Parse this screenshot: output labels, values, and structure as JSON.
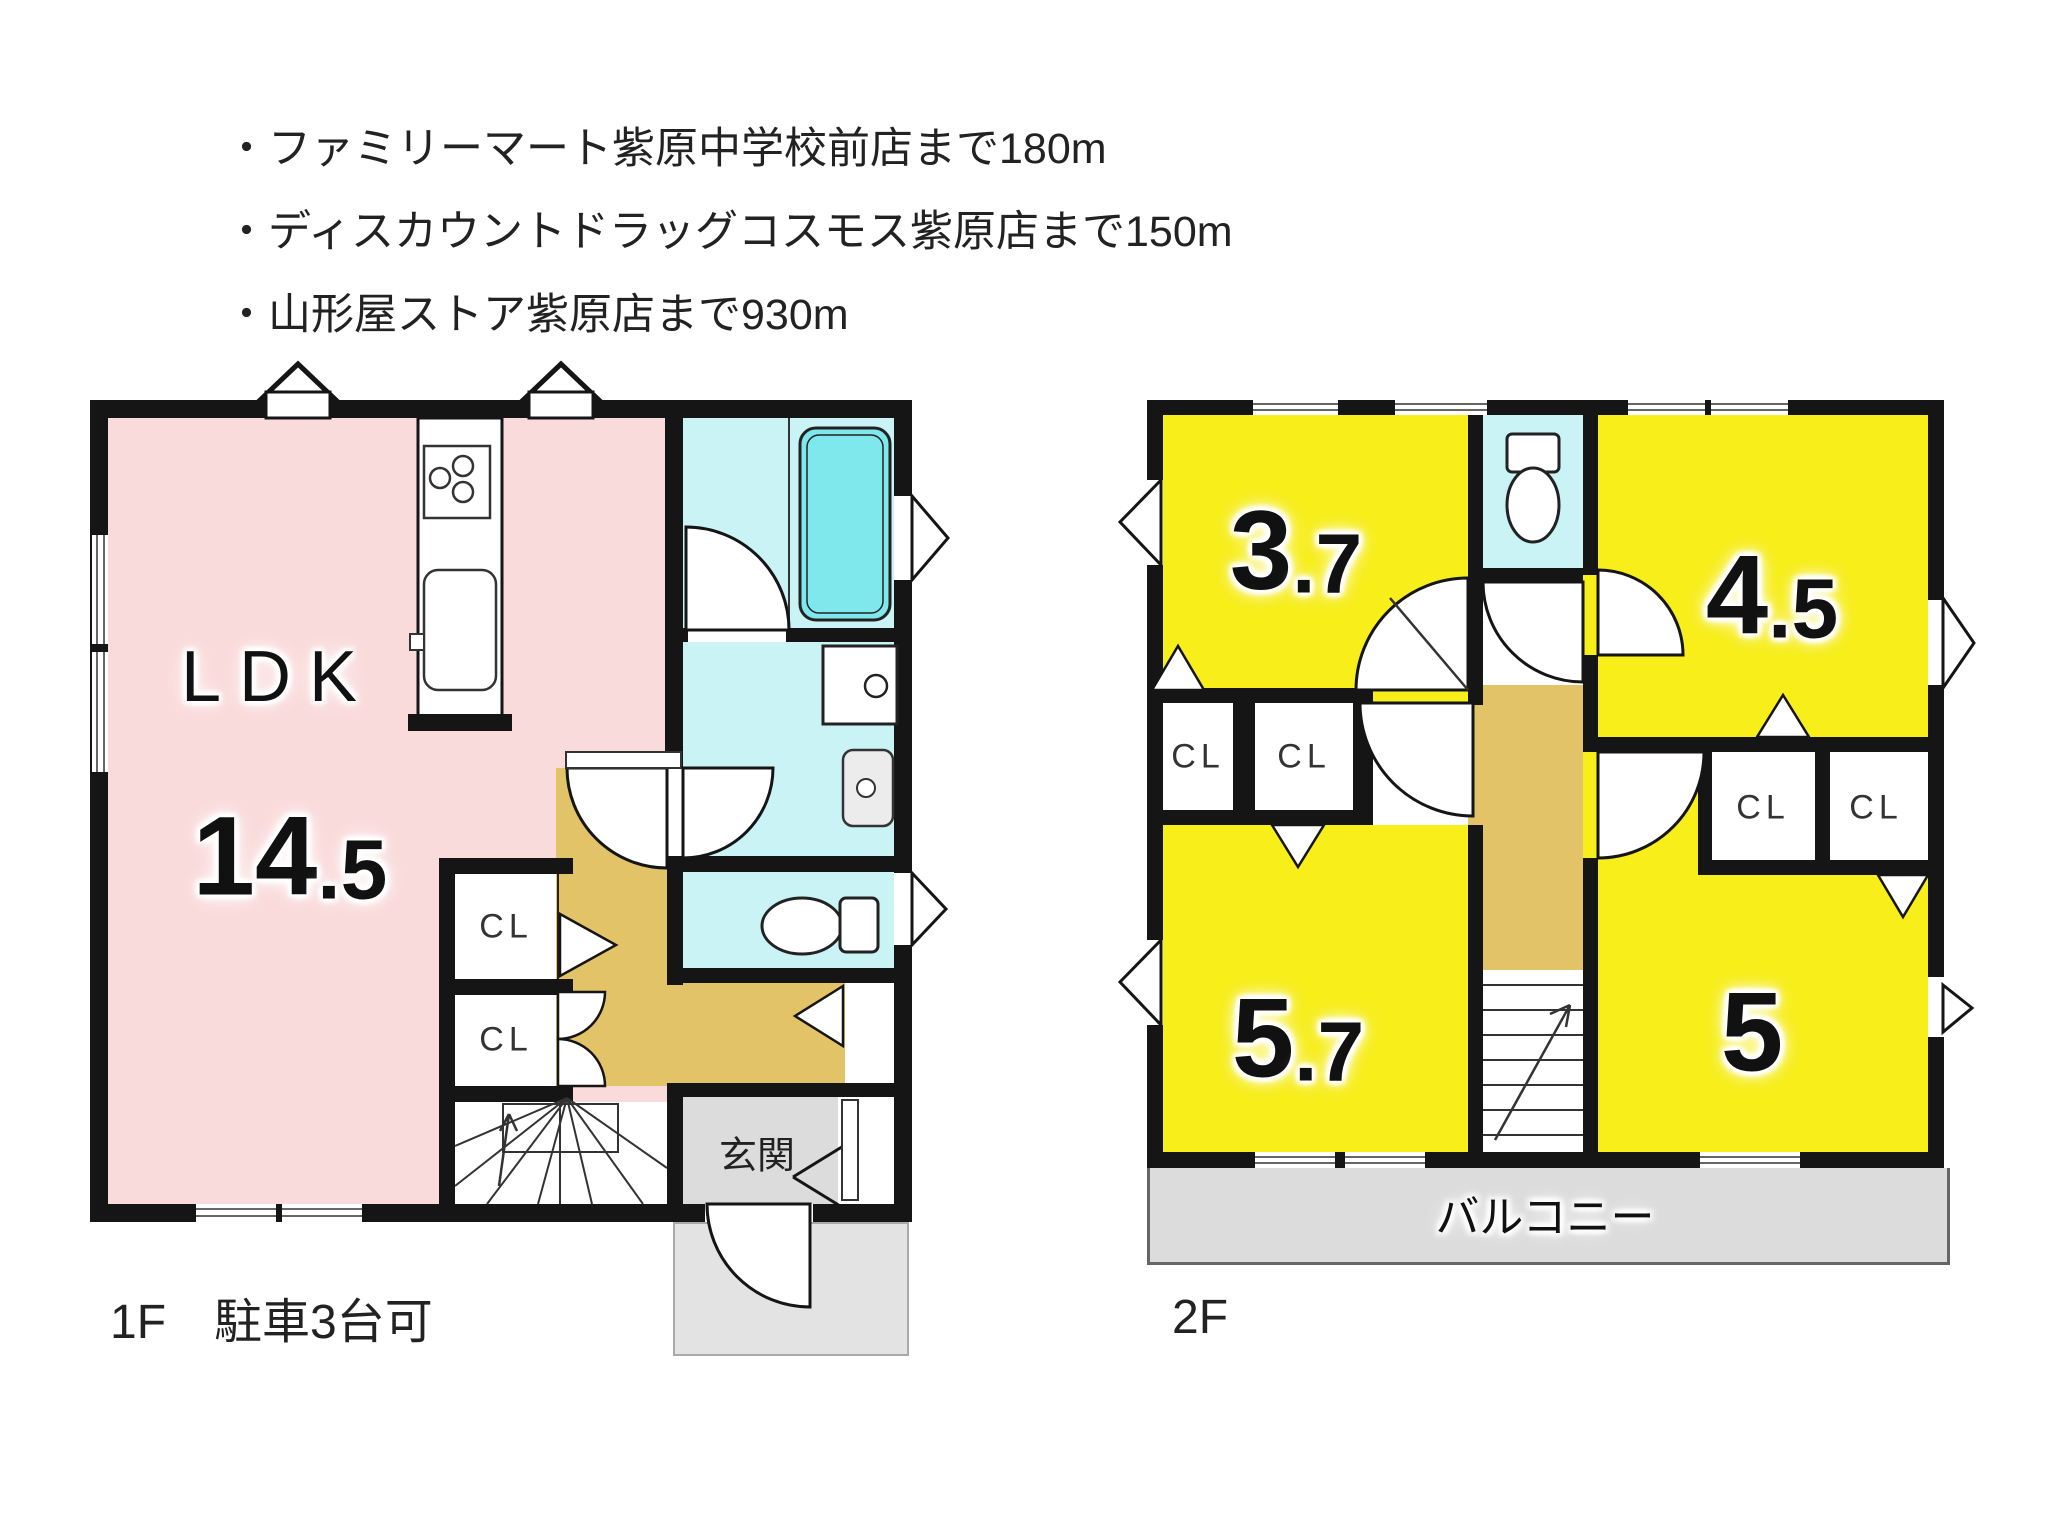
{
  "notes": {
    "items": [
      "・ファミリーマート紫原中学校前店まで180m",
      "・ディスカウントドラッグコスモス紫原店まで150m",
      "・山形屋ストア紫原店まで930m"
    ]
  },
  "floor1": {
    "caption": "1F　駐車3台可",
    "ldk_label": "LDK",
    "ldk_size_main": "14",
    "ldk_size_sub": ".5",
    "cl1": "CL",
    "cl2": "CL",
    "entrance": "玄関"
  },
  "floor2": {
    "caption": "2F",
    "balcony": "バルコニー",
    "rooms": {
      "r37_main": "3",
      "r37_sub": ".7",
      "r45_main": "4",
      "r45_sub": ".5",
      "r57_main": "5",
      "r57_sub": ".7",
      "r5_main": "5"
    },
    "closets": {
      "c1": "CL",
      "c2": "CL",
      "c3": "CL",
      "c4": "CL"
    }
  },
  "colors": {
    "ldk_pink": "#fadbdb",
    "room_yellow": "#f7ee1a",
    "wet_cyan": "#c9f3f4",
    "tub_cyan": "#7fe8ec",
    "hall_tan": "#e2c368",
    "entrance_gray": "#dcdcdc",
    "wall_black": "#151515"
  }
}
